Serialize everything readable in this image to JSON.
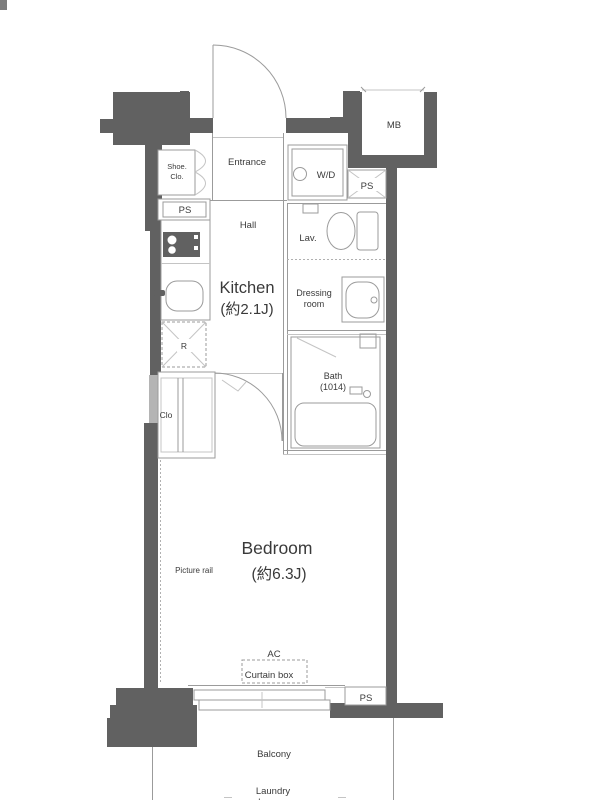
{
  "rooms": {
    "entrance": {
      "label": "Entrance"
    },
    "shoe_closet": {
      "line1": "Shoe.",
      "line2": "Clo."
    },
    "hall": {
      "label": "Hall"
    },
    "kitchen": {
      "name": "Kitchen",
      "size": "(約2.1J)"
    },
    "wd": {
      "label": "W/D"
    },
    "lavatory": {
      "label": "Lav."
    },
    "dressing_room": {
      "line1": "Dressing",
      "line2": "room"
    },
    "bath": {
      "name": "Bath",
      "size": "(1014)"
    },
    "closet": {
      "label": "Clo"
    },
    "bedroom": {
      "name": "Bedroom",
      "size": "(約6.3J)"
    },
    "balcony": {
      "label": "Balcony"
    },
    "meter_box": {
      "label": "MB"
    }
  },
  "fixtures": {
    "refrigerator": "R",
    "pipe_space": "PS",
    "picture_rail": "Picture rail",
    "air_conditioner": "AC",
    "curtain_box": "Curtain box",
    "laundry_hanger": {
      "line1": "Laundry",
      "line2": "hanger"
    }
  },
  "colors": {
    "wall": "#616161",
    "line": "#9b9b9b",
    "light_line": "#c4c4c4",
    "text": "#3a3a3a",
    "background": "#ffffff",
    "wall_window": "#b4b4b4"
  }
}
